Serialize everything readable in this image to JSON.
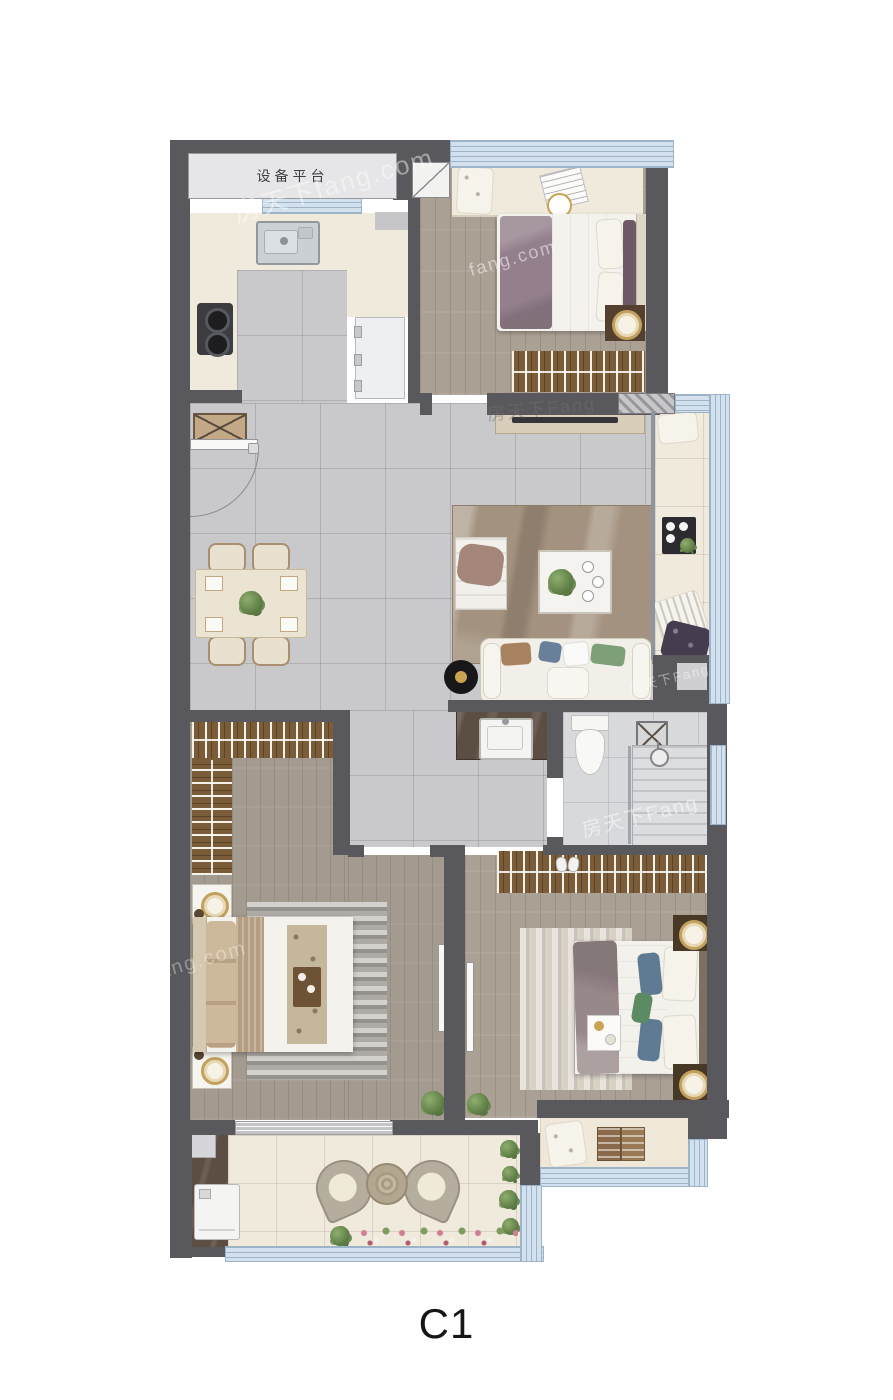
{
  "plan": {
    "unit_label": "C1",
    "equipment_platform_label": "设备平台",
    "watermark": "房天下fang.com",
    "watermark_short": "房天下Fang",
    "watermark_com": "fang.com"
  },
  "colors": {
    "wall": "#59585c",
    "window_fill": "#d3e1ee",
    "window_line": "#9db4c8",
    "tile": "#c9c9cb",
    "wood": "#aba094",
    "wood2": "#a39b90",
    "cream": "#f0eadd",
    "bath": "#d8d9db",
    "counter": "#5c4e43",
    "wardrobe": "#7a5c39",
    "rug_living": "#a3927f",
    "accent_green": "#6d8b58",
    "label": "#161616"
  }
}
